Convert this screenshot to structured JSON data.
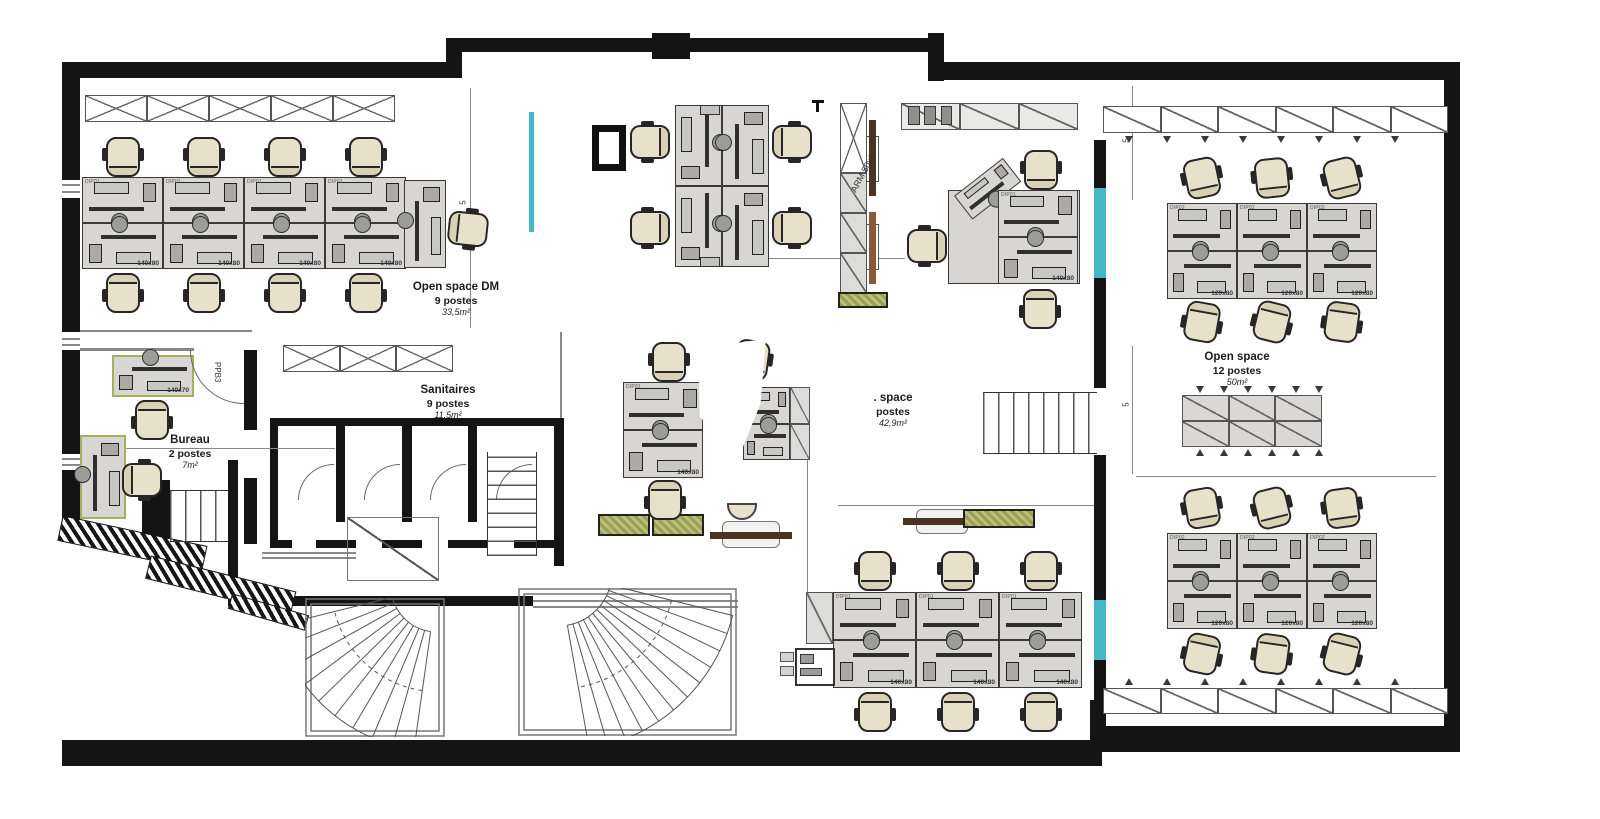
{
  "rooms": {
    "open_space_dm": {
      "name": "Open space DM",
      "capacity": "9 postes",
      "area": "33,5m²"
    },
    "sanitaires": {
      "name": "Sanitaires",
      "capacity": "9 postes",
      "area": "11,5m²"
    },
    "bureau": {
      "name": "Bureau",
      "capacity": "2 postes",
      "area": "7m²"
    },
    "open_space_center": {
      "name": ". space",
      "capacity": "postes",
      "area": "42,9m²"
    },
    "open_space_right": {
      "name": "Open space",
      "capacity": "12 postes",
      "area": "50m²"
    }
  },
  "labels": {
    "desk_size_140": "140x80",
    "desk_size_120": "120x80",
    "desk_size_bureau": "140x70",
    "desk_tag_a": "DIP01",
    "desk_tag_b": "DIP02",
    "door_tag": "PPB3",
    "cabinet_tag": "ARM 50x6",
    "dim_5": "5"
  },
  "colors": {
    "wall": "#141414",
    "desk_fill": "#d7d6d2",
    "chair_fill": "#e7e0ca",
    "glazing": "#45b8c8",
    "plant": "#a9ab64",
    "bureau_desk_outline": "#a3b05c",
    "bench_dark": "#4a3322",
    "bench_brown": "#8a5a38"
  }
}
